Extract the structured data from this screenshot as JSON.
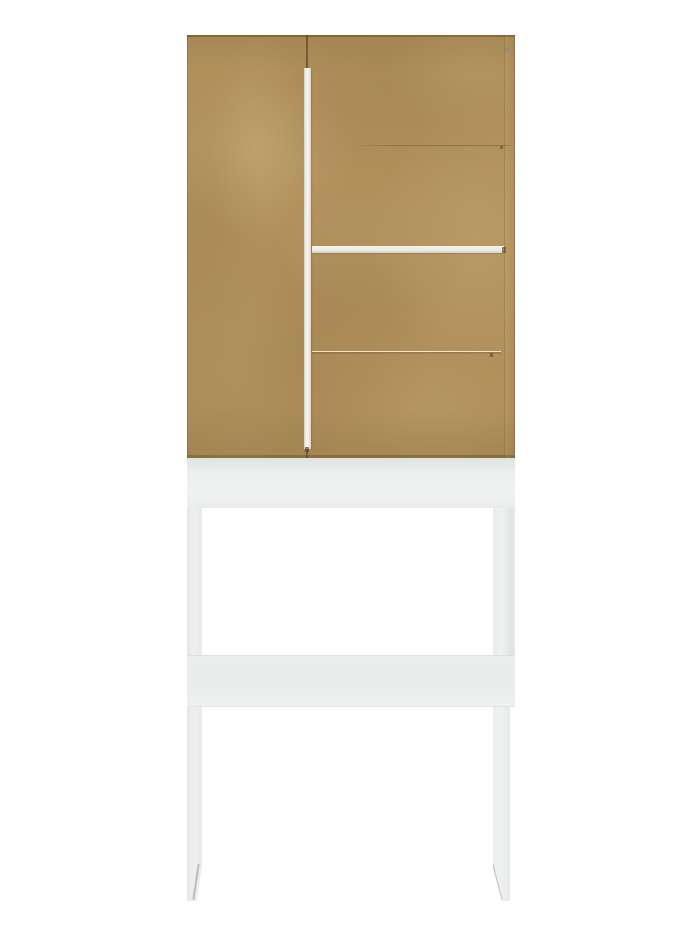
{
  "scene": {
    "type": "product-photo",
    "subject": "over-toilet space-saver cabinet with wooden two-door upper unit on a tall white leg frame",
    "background": "plain white studio background",
    "visible_text": "none"
  },
  "colors": {
    "bg": "#ffffff",
    "wood": "#b1905a",
    "wood-edge": "#7e633a",
    "handle-white": "#f5f4ef",
    "handle-shade": "#d2d0c7",
    "base-white": "#e9eceb",
    "base-shade": "#dfe3e2",
    "screw": "#8f8d82"
  },
  "parts": {
    "cabinet": "upper two-door cabinet in raw MDF tan finish",
    "left_door": "plain left door",
    "right_door": "right door with two faint horizontal panel seams",
    "vertical_handle": "long white vertical bar handle between doors",
    "horizontal_handle": "white horizontal bar handle across right door middle",
    "apron": "white top panel of the base frame directly under cabinet",
    "left_leg": "white left leg with chamfered inner foot",
    "right_leg": "white right leg with chamfered inner foot",
    "crossbar": "white horizontal crossbar joining the legs"
  }
}
